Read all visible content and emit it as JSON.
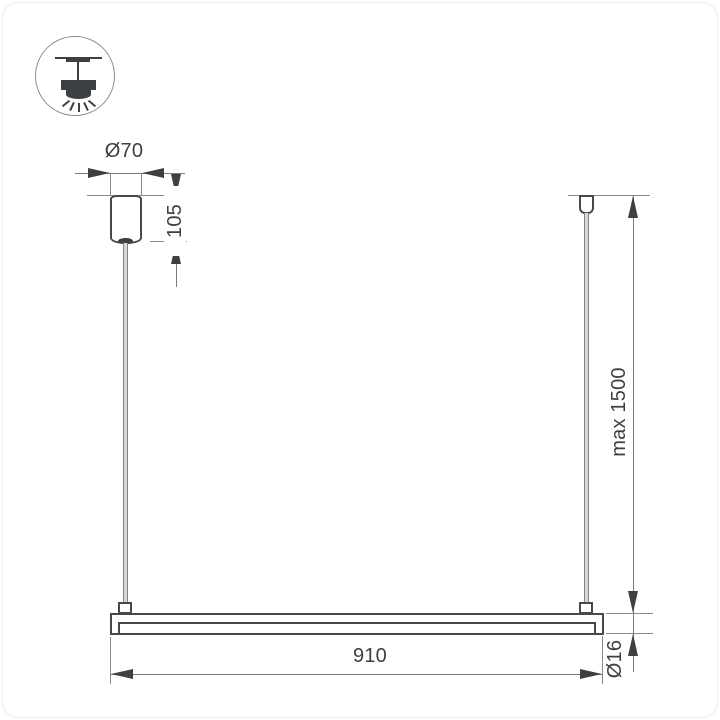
{
  "title": "linear pendant luminaire dimension drawing",
  "colors": {
    "line": "#46484b",
    "dim": "#7a7a7a",
    "fill": "#3d4043",
    "text": "#3d4043"
  },
  "icons": {
    "top_left": "pendant-ceiling-light-icon"
  },
  "dims": {
    "canopy_diameter": "Ø70",
    "canopy_height": "105",
    "max_drop": "max 1500",
    "bar_length": "910",
    "bar_diameter": "Ø16"
  }
}
